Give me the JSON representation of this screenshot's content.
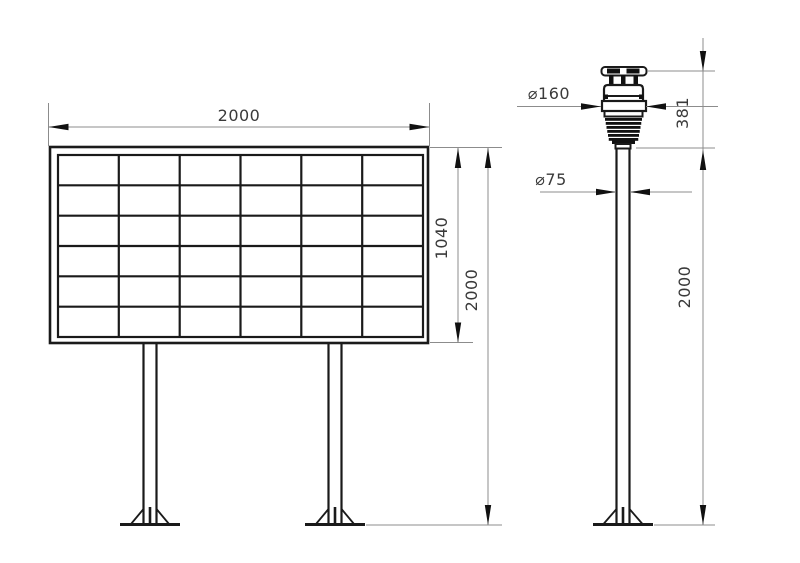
{
  "drawing": {
    "type": "technical-dimension-drawing",
    "background": "#ffffff",
    "object_line_color": "#1a1a1a",
    "dimension_line_color": "#8c8c8c",
    "text_color": "#3a3a3a",
    "views": {
      "display_board": {
        "description": "front view of grid display board on two legs",
        "grid_rows": 6,
        "grid_columns": 6
      },
      "weather_station": {
        "description": "side view of sensor head on pole"
      }
    }
  },
  "dims": {
    "board_width": "2000",
    "board_panel_height": "1040",
    "board_total_height": "2000",
    "sensor_diameter": "⌀160",
    "sensor_height": "381",
    "pole_diameter": "⌀75",
    "pole_height": "2000"
  }
}
